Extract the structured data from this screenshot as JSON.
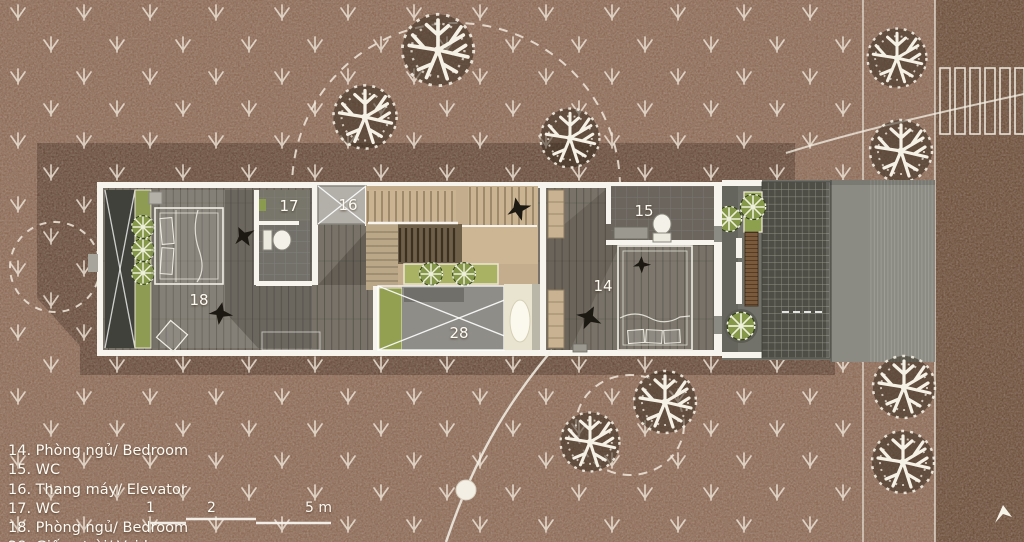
{
  "legend": {
    "items": [
      "14. Phòng ngủ/ Bedroom",
      "15. WC",
      "16. Thang máy/ Elevator",
      "17. WC",
      "18. Phòng ngủ/ Bedroom",
      "28. Giếng trời/ Void"
    ]
  },
  "scale_bar": {
    "tick_1": "1",
    "tick_2": "2",
    "tick_5": "5 m"
  },
  "plan": {
    "room_labels": {
      "r14": "14",
      "r15": "15",
      "r16": "16",
      "r17": "17",
      "r18": "18",
      "r28": "28"
    }
  },
  "colors": {
    "ground": "#8d6c59",
    "site_shadow": "#6b5040",
    "road": "#6f523f",
    "pavement": "#8b8b83",
    "wall_white": "#f7f4ee",
    "wood_floor": "#787268",
    "stair_tan": "#c3ad8c",
    "green_planter": "#8e9b52",
    "pergola_grid": "#50504a",
    "accent_line": "#f5f1e6"
  },
  "icons": {
    "tree": "coral-tree-top-view",
    "plant": "shrub-top-view",
    "bird": "bird-silhouette",
    "ground_cover": "arrow-down-mark",
    "cursor": "white-arrowhead"
  }
}
